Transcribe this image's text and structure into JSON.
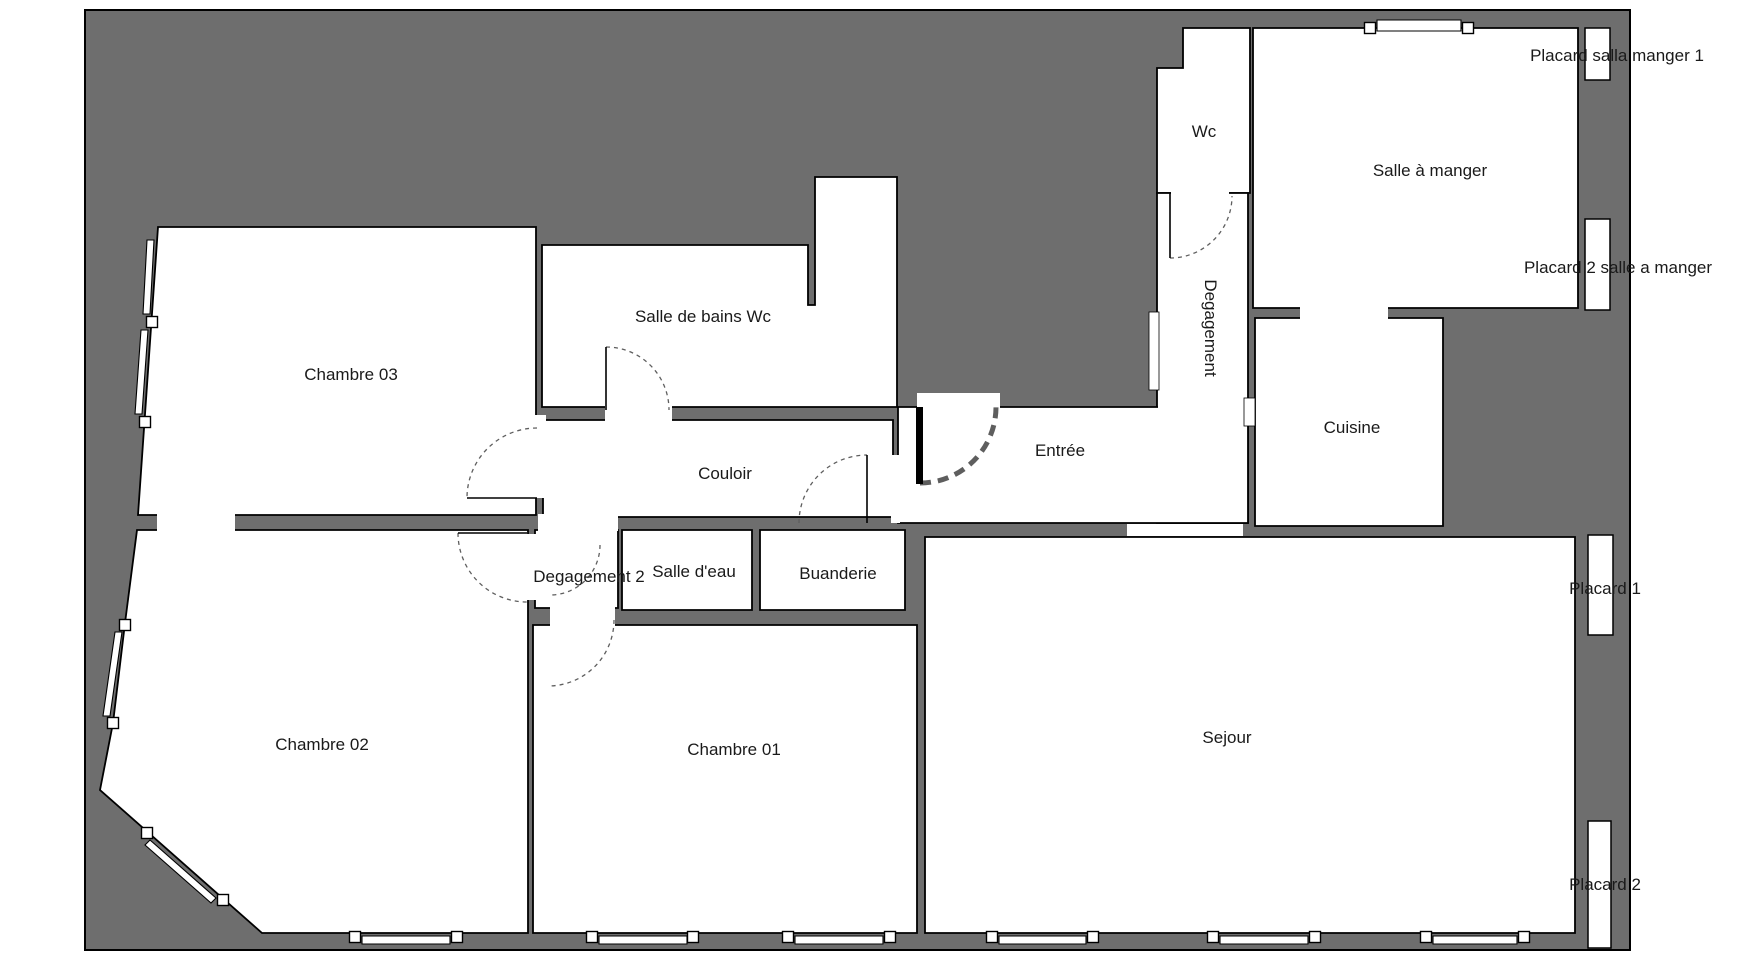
{
  "canvas": {
    "width": 1748,
    "height": 974,
    "page_bg": "#ffffff",
    "wall_fill": "#6e6e6e",
    "room_fill": "#ffffff",
    "outline_color": "#000000",
    "door_arc_color": "#5e5e5e",
    "text_color": "#1a1a1a",
    "font_size": 17
  },
  "plan_border": {
    "x": 85,
    "y": 10,
    "w": 1545,
    "h": 940
  },
  "rooms": [
    {
      "id": "chambre-03",
      "points": [
        [
          158,
          227
        ],
        [
          536,
          227
        ],
        [
          536,
          515
        ],
        [
          138,
          515
        ]
      ]
    },
    {
      "id": "chambre-02",
      "points": [
        [
          137,
          530
        ],
        [
          528,
          530
        ],
        [
          528,
          933
        ],
        [
          262,
          933
        ],
        [
          100,
          790
        ],
        [
          113,
          723
        ],
        [
          125,
          623
        ]
      ]
    },
    {
      "id": "chambre-01",
      "points": [
        [
          533,
          625
        ],
        [
          917,
          625
        ],
        [
          917,
          933
        ],
        [
          533,
          933
        ]
      ]
    },
    {
      "id": "sejour",
      "points": [
        [
          925,
          537
        ],
        [
          1575,
          537
        ],
        [
          1575,
          933
        ],
        [
          925,
          933
        ]
      ]
    },
    {
      "id": "couloir",
      "points": [
        [
          543,
          420
        ],
        [
          893,
          420
        ],
        [
          893,
          517
        ],
        [
          543,
          517
        ]
      ]
    },
    {
      "id": "degagement-2",
      "points": [
        [
          535,
          530
        ],
        [
          618,
          530
        ],
        [
          618,
          608
        ],
        [
          535,
          608
        ]
      ]
    },
    {
      "id": "salle-deau",
      "points": [
        [
          622,
          530
        ],
        [
          752,
          530
        ],
        [
          752,
          610
        ],
        [
          622,
          610
        ]
      ]
    },
    {
      "id": "buanderie",
      "points": [
        [
          760,
          530
        ],
        [
          905,
          530
        ],
        [
          905,
          610
        ],
        [
          760,
          610
        ]
      ]
    },
    {
      "id": "salle-de-bains-wc",
      "points": [
        [
          542,
          245
        ],
        [
          808,
          245
        ],
        [
          808,
          305
        ],
        [
          815,
          305
        ],
        [
          815,
          177
        ],
        [
          897,
          177
        ],
        [
          897,
          407
        ],
        [
          542,
          407
        ]
      ]
    },
    {
      "id": "wc",
      "points": [
        [
          1183,
          28
        ],
        [
          1250,
          28
        ],
        [
          1250,
          193
        ],
        [
          1157,
          193
        ],
        [
          1157,
          68
        ],
        [
          1183,
          68
        ]
      ]
    },
    {
      "id": "degagement-corridor",
      "points": [
        [
          1157,
          193
        ],
        [
          1248,
          193
        ],
        [
          1248,
          523
        ],
        [
          1157,
          523
        ]
      ]
    },
    {
      "id": "entree",
      "points": [
        [
          898,
          407
        ],
        [
          1248,
          407
        ],
        [
          1248,
          523
        ],
        [
          898,
          523
        ]
      ]
    },
    {
      "id": "cuisine",
      "points": [
        [
          1255,
          318
        ],
        [
          1443,
          318
        ],
        [
          1443,
          526
        ],
        [
          1255,
          526
        ]
      ]
    },
    {
      "id": "salle-a-manger",
      "points": [
        [
          1253,
          28
        ],
        [
          1578,
          28
        ],
        [
          1578,
          308
        ],
        [
          1253,
          308
        ]
      ]
    }
  ],
  "openings": [
    {
      "id": "opening-c03-c02",
      "x": 157,
      "y": 514,
      "w": 78,
      "h": 17
    },
    {
      "id": "opening-couloir-deg2",
      "x": 538,
      "y": 514,
      "w": 80,
      "h": 17
    },
    {
      "id": "opening-c02-deg2",
      "x": 526,
      "y": 534,
      "w": 11,
      "h": 66
    },
    {
      "id": "opening-c03-couloir",
      "x": 533,
      "y": 415,
      "w": 13,
      "h": 83
    },
    {
      "id": "opening-deg2-c01",
      "x": 550,
      "y": 606,
      "w": 65,
      "h": 21
    },
    {
      "id": "opening-sdb-couloir",
      "x": 605,
      "y": 404,
      "w": 67,
      "h": 18
    },
    {
      "id": "opening-couloir-entree",
      "x": 891,
      "y": 455,
      "w": 9,
      "h": 68
    },
    {
      "id": "opening-entrance-door",
      "x": 917,
      "y": 393,
      "w": 83,
      "h": 16
    },
    {
      "id": "opening-wc-corridor",
      "x": 1171,
      "y": 189,
      "w": 58,
      "h": 8
    },
    {
      "id": "opening-corridor-sejour",
      "x": 1127,
      "y": 524,
      "w": 116,
      "h": 12
    },
    {
      "id": "opening-sam-cuisine",
      "x": 1300,
      "y": 306,
      "w": 88,
      "h": 14
    },
    {
      "id": "opening-corridor-entree",
      "x": 1158,
      "y": 402,
      "w": 89,
      "h": 10
    },
    {
      "id": "opening-corridor-entree-v",
      "x": 1152,
      "y": 409,
      "w": 10,
      "h": 112
    }
  ],
  "notches": [
    {
      "id": "wall-notch-corridor",
      "x": 1149,
      "y": 312,
      "w": 10,
      "h": 78
    },
    {
      "id": "wall-notch-cuisine",
      "x": 1244,
      "y": 398,
      "w": 11,
      "h": 28
    }
  ],
  "windows": {
    "bands": [
      {
        "id": "window-c03-left-upper",
        "points": [
          [
            154,
            240
          ],
          [
            150,
            314
          ],
          [
            143,
            314
          ],
          [
            147,
            240
          ]
        ]
      },
      {
        "id": "window-c03-left-lower",
        "points": [
          [
            148,
            330
          ],
          [
            142,
            414
          ],
          [
            135,
            414
          ],
          [
            141,
            330
          ]
        ]
      },
      {
        "id": "window-c02-left",
        "points": [
          [
            122,
            632
          ],
          [
            110,
            716
          ],
          [
            103,
            716
          ],
          [
            115,
            632
          ]
        ]
      },
      {
        "id": "window-c02-diagonal",
        "points": [
          [
            150,
            840
          ],
          [
            216,
            898
          ],
          [
            211,
            903
          ],
          [
            145,
            845
          ]
        ]
      },
      {
        "id": "window-c02-bottom",
        "points": [
          [
            362,
            936
          ],
          [
            450,
            936
          ],
          [
            450,
            944
          ],
          [
            362,
            944
          ]
        ]
      },
      {
        "id": "window-c01-bottom-1",
        "points": [
          [
            599,
            936
          ],
          [
            687,
            936
          ],
          [
            687,
            944
          ],
          [
            599,
            944
          ]
        ]
      },
      {
        "id": "window-c01-bottom-2",
        "points": [
          [
            795,
            936
          ],
          [
            883,
            936
          ],
          [
            883,
            944
          ],
          [
            795,
            944
          ]
        ]
      },
      {
        "id": "window-sejour-bottom-1",
        "points": [
          [
            999,
            936
          ],
          [
            1086,
            936
          ],
          [
            1086,
            944
          ],
          [
            999,
            944
          ]
        ]
      },
      {
        "id": "window-sejour-bottom-2",
        "points": [
          [
            1220,
            936
          ],
          [
            1308,
            936
          ],
          [
            1308,
            944
          ],
          [
            1220,
            944
          ]
        ]
      },
      {
        "id": "window-sejour-bottom-3",
        "points": [
          [
            1433,
            936
          ],
          [
            1517,
            936
          ],
          [
            1517,
            944
          ],
          [
            1433,
            944
          ]
        ]
      },
      {
        "id": "window-sam-top",
        "points": [
          [
            1377,
            20
          ],
          [
            1461,
            20
          ],
          [
            1461,
            31
          ],
          [
            1377,
            31
          ]
        ]
      }
    ],
    "squares": [
      [
        152,
        322
      ],
      [
        145,
        422
      ],
      [
        125,
        625
      ],
      [
        113,
        723
      ],
      [
        147,
        833
      ],
      [
        223,
        900
      ],
      [
        355,
        937
      ],
      [
        457,
        937
      ],
      [
        592,
        937
      ],
      [
        693,
        937
      ],
      [
        788,
        937
      ],
      [
        890,
        937
      ],
      [
        992,
        937
      ],
      [
        1093,
        937
      ],
      [
        1213,
        937
      ],
      [
        1315,
        937
      ],
      [
        1426,
        937
      ],
      [
        1524,
        937
      ],
      [
        1370,
        28
      ],
      [
        1468,
        28
      ]
    ],
    "square_size": 11
  },
  "placards": [
    {
      "id": "placard-salle-manger-1",
      "x": 1585,
      "y": 28,
      "w": 25,
      "h": 52
    },
    {
      "id": "placard-2-salle-manger",
      "x": 1585,
      "y": 219,
      "w": 25,
      "h": 91
    },
    {
      "id": "placard-1",
      "x": 1588,
      "y": 535,
      "w": 25,
      "h": 100
    },
    {
      "id": "placard-2",
      "x": 1588,
      "y": 821,
      "w": 23,
      "h": 127
    }
  ],
  "doors": {
    "arcs": [
      {
        "id": "door-arc-chambre-03",
        "sx": 537,
        "sy": 428,
        "ex": 467,
        "ey": 498,
        "r": 70,
        "sweep": 0,
        "thick": false
      },
      {
        "id": "door-arc-chambre-02",
        "sx": 458,
        "sy": 533,
        "ex": 527,
        "ey": 602,
        "r": 69,
        "sweep": 0,
        "thick": false
      },
      {
        "id": "door-arc-degagement-2",
        "sx": 600,
        "sy": 545,
        "ex": 550,
        "ey": 595,
        "r": 50,
        "sweep": 1,
        "thick": false
      },
      {
        "id": "door-arc-chambre-01",
        "sx": 614,
        "sy": 620,
        "ex": 548,
        "ey": 686,
        "r": 66,
        "sweep": 1,
        "thick": false
      },
      {
        "id": "door-arc-salle-de-bains",
        "sx": 606,
        "sy": 347,
        "ex": 669,
        "ey": 410,
        "r": 63,
        "sweep": 1,
        "thick": false
      },
      {
        "id": "door-arc-couloir-entree",
        "sx": 799,
        "sy": 523,
        "ex": 867,
        "ey": 455,
        "r": 68,
        "sweep": 1,
        "thick": false
      },
      {
        "id": "door-arc-wc",
        "sx": 1170,
        "sy": 258,
        "ex": 1232,
        "ey": 196,
        "r": 62,
        "sweep": 0,
        "thick": false
      },
      {
        "id": "door-arc-entrance",
        "sx": 920,
        "sy": 483,
        "ex": 996,
        "ey": 407,
        "r": 76,
        "sweep": 0,
        "thick": true
      }
    ],
    "leaves": [
      {
        "id": "door-leaf-chambre-03",
        "x1": 467,
        "y1": 498,
        "x2": 537,
        "y2": 498
      },
      {
        "id": "door-leaf-chambre-02",
        "x1": 458,
        "y1": 533,
        "x2": 527,
        "y2": 533
      },
      {
        "id": "door-leaf-salle-de-bains",
        "x1": 606,
        "y1": 347,
        "x2": 606,
        "y2": 410
      },
      {
        "id": "door-leaf-wc",
        "x1": 1170,
        "y1": 193,
        "x2": 1170,
        "y2": 258
      },
      {
        "id": "door-leaf-couloir-entree",
        "x1": 867,
        "y1": 455,
        "x2": 867,
        "y2": 523
      }
    ],
    "entrance_leaf": {
      "id": "door-leaf-entrance",
      "x": 916,
      "y": 407,
      "w": 7,
      "h": 77
    }
  },
  "labels": [
    {
      "id": "label-chambre-03",
      "text": "Chambre 03",
      "x": 351,
      "y": 380,
      "rotate": 0
    },
    {
      "id": "label-chambre-02",
      "text": "Chambre 02",
      "x": 322,
      "y": 750,
      "rotate": 0
    },
    {
      "id": "label-chambre-01",
      "text": "Chambre 01",
      "x": 734,
      "y": 755,
      "rotate": 0
    },
    {
      "id": "label-salle-de-bains-wc",
      "text": "Salle de bains Wc",
      "x": 703,
      "y": 322,
      "rotate": 0
    },
    {
      "id": "label-couloir",
      "text": "Couloir",
      "x": 725,
      "y": 479,
      "rotate": 0
    },
    {
      "id": "label-degagement-2",
      "text": "Degagement 2",
      "x": 589,
      "y": 582,
      "rotate": 0
    },
    {
      "id": "label-salle-deau",
      "text": "Salle d'eau",
      "x": 694,
      "y": 577,
      "rotate": 0
    },
    {
      "id": "label-buanderie",
      "text": "Buanderie",
      "x": 838,
      "y": 579,
      "rotate": 0
    },
    {
      "id": "label-entree",
      "text": "Entrée",
      "x": 1060,
      "y": 456,
      "rotate": 0
    },
    {
      "id": "label-sejour",
      "text": "Sejour",
      "x": 1227,
      "y": 743,
      "rotate": 0
    },
    {
      "id": "label-wc",
      "text": "Wc",
      "x": 1204,
      "y": 137,
      "rotate": 0
    },
    {
      "id": "label-degagement",
      "text": "Degagement",
      "x": 1205,
      "y": 328,
      "rotate": 90
    },
    {
      "id": "label-cuisine",
      "text": "Cuisine",
      "x": 1352,
      "y": 433,
      "rotate": 0
    },
    {
      "id": "label-salle-a-manger",
      "text": "Salle à manger",
      "x": 1430,
      "y": 176,
      "rotate": 0
    },
    {
      "id": "label-placard-salla-manger-1",
      "text": "Placard salla manger 1",
      "x": 1617,
      "y": 61,
      "rotate": 0
    },
    {
      "id": "label-placard-2-salle-manger",
      "text": "Placard 2 salle a manger",
      "x": 1618,
      "y": 273,
      "rotate": 0
    },
    {
      "id": "label-placard-1",
      "text": "Placard 1",
      "x": 1605,
      "y": 594,
      "rotate": 0
    },
    {
      "id": "label-placard-2",
      "text": "Placard 2",
      "x": 1605,
      "y": 890,
      "rotate": 0
    }
  ]
}
